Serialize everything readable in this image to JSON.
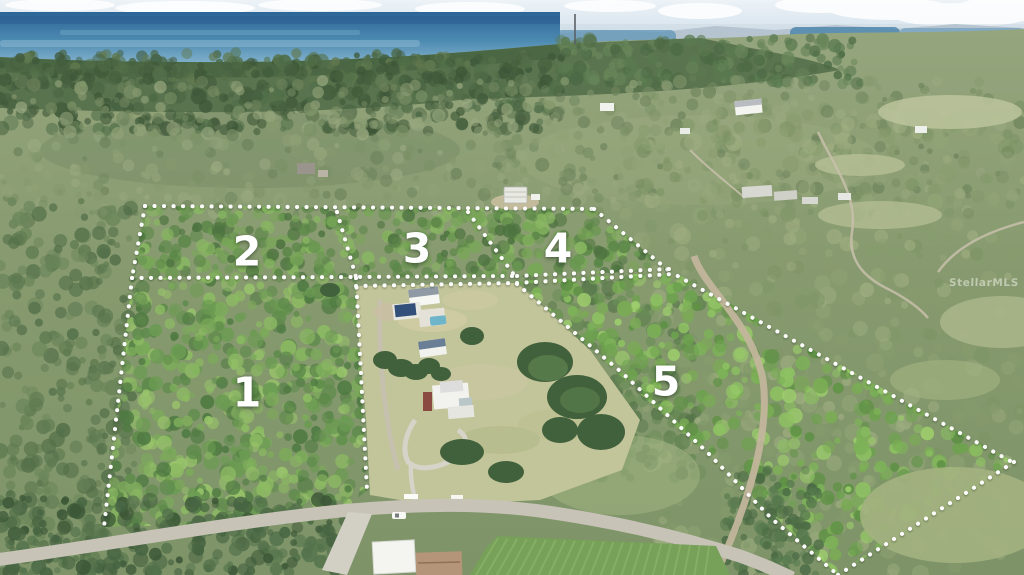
{
  "parcels": [
    {
      "label": "1"
    },
    {
      "label": "2"
    },
    {
      "label": "3"
    },
    {
      "label": "4"
    },
    {
      "label": "5"
    }
  ],
  "watermark": {
    "text": "StellarMLS"
  },
  "colors": {
    "boundary_line": "#ffffff",
    "ocean": "#3a7aa8",
    "sky_haze": "#d7e4ee",
    "tree_canopy": "#5d8749",
    "parcel5_canopy": "#7db258",
    "estate_grass": "#c2c499",
    "road": "#c7c3b7",
    "dirt_road": "#c2b59c"
  }
}
